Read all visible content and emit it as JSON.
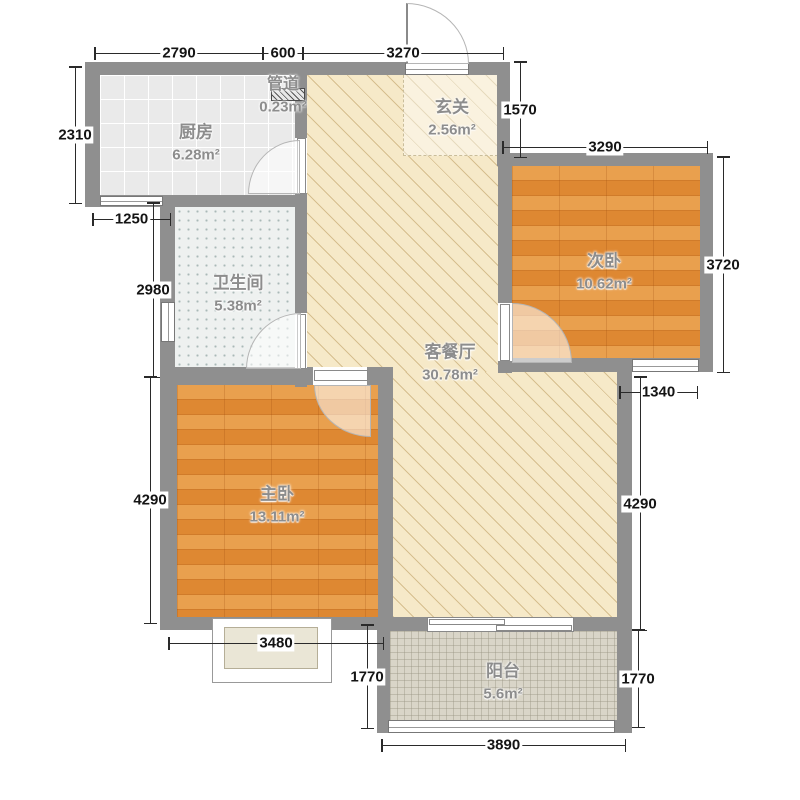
{
  "plan": {
    "type": "apartment-floor-plan",
    "rooms": {
      "kitchen": {
        "name": "厨房",
        "area": "6.28m²"
      },
      "duct": {
        "name": "管道",
        "area": "0.23m²"
      },
      "entry": {
        "name": "玄关",
        "area": "2.56m²"
      },
      "bedroom2": {
        "name": "次卧",
        "area": "10.62m²"
      },
      "bathroom": {
        "name": "卫生间",
        "area": "5.38m²"
      },
      "living": {
        "name": "客餐厅",
        "area": "30.78m²"
      },
      "master": {
        "name": "主卧",
        "area": "13.11m²"
      },
      "balcony": {
        "name": "阳台",
        "area": "5.6m²"
      }
    },
    "dims": {
      "kitchen_width": "2790",
      "duct_width": "600",
      "entry_width": "3270",
      "kitchen_height": "2310",
      "kitchen_window": "1250",
      "bathroom_height": "2980",
      "entry_side_height": "1570",
      "bedroom2_width": "3290",
      "bedroom2_height": "3720",
      "bedroom2_window": "1340",
      "master_side_height": "4290",
      "living_side_height": "4290",
      "master_width": "3480",
      "balcony_left_height": "1770",
      "balcony_right_height": "1770",
      "balcony_width": "3890"
    },
    "colors": {
      "wall": "#8f8f8f",
      "living_floor": "#f6e9c8",
      "wood_floor": "#e08a33",
      "kitchen_floor": "#eaeaea",
      "bathroom_floor": "#eef1f0",
      "balcony_floor": "#d9d5c8"
    }
  }
}
